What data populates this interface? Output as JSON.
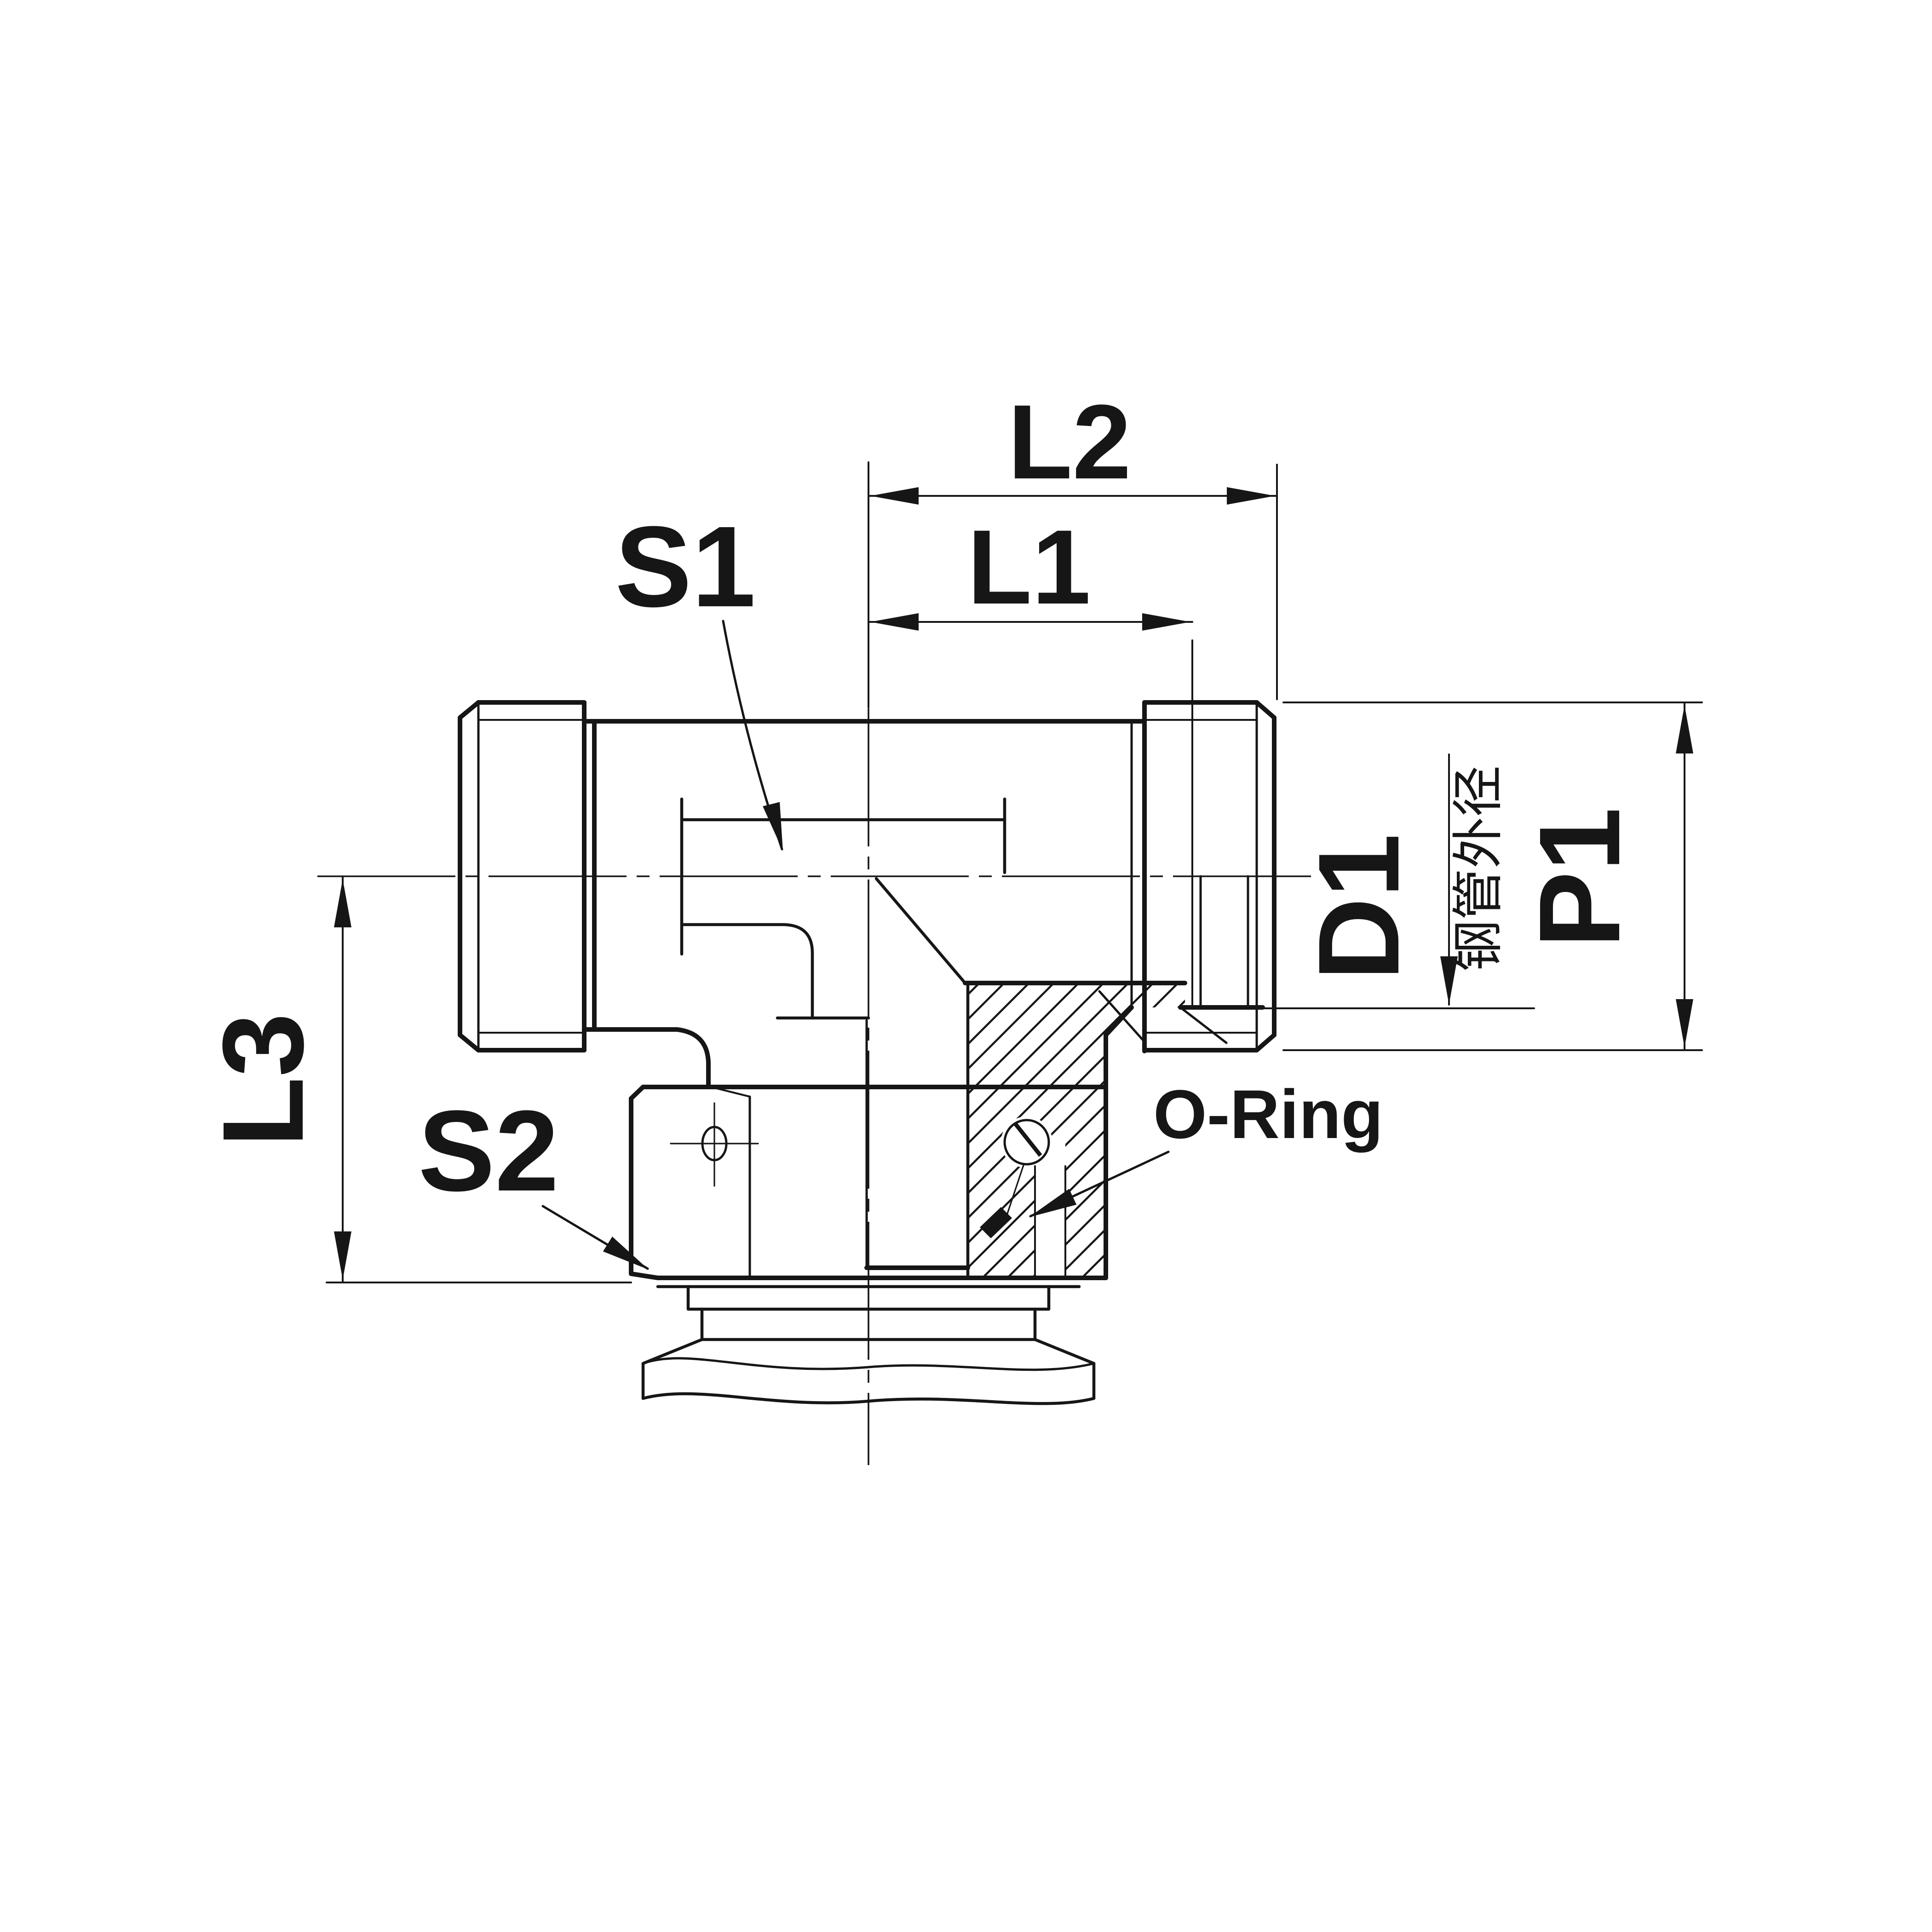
{
  "drawing": {
    "labels": {
      "s1": "S1",
      "s2": "S2",
      "l1": "L1",
      "l2": "L2",
      "l3": "L3",
      "d1": "D1",
      "p1": "P1",
      "o_ring": "O-Ring",
      "d1_note": "钢管外径"
    },
    "colors": {
      "line": "#161616",
      "background": "#ffffff"
    }
  }
}
